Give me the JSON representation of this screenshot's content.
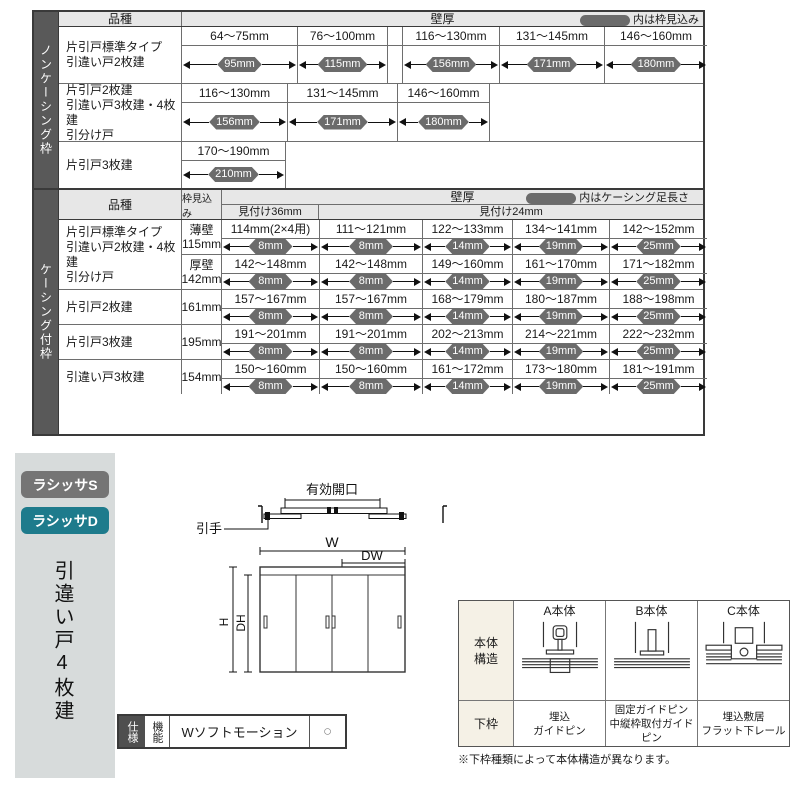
{
  "colors": {
    "accent_teal": "#1e7b8c",
    "badge_gray": "#757575",
    "capsule_gray": "#6b6b6b",
    "side_band_gray": "#595959",
    "header_bg": "#e7e7e7",
    "label_cream": "#f5f1e6",
    "sidebar_bg": "#d7dbdb"
  },
  "table1": {
    "side_label": "ノンケーシング枠",
    "header": {
      "kind": "品種",
      "wall": "壁厚",
      "legend": "内は枠見込み"
    },
    "rows": [
      {
        "label": "片引戸標準タイプ\n引違い戸2枚建",
        "h": 56,
        "subs": [
          {
            "fill": false,
            "cells": [
              {
                "range": "64〜75mm",
                "val": "95mm",
                "w": 115
              },
              {
                "range": "76〜100mm",
                "val": "115mm",
                "w": 90
              },
              {
                "spacer": true,
                "w": 15
              },
              {
                "range": "116〜130mm",
                "val": "156mm",
                "w": 97
              },
              {
                "range": "131〜145mm",
                "val": "171mm",
                "w": 105
              },
              {
                "range": "146〜160mm",
                "val": "180mm",
                "w": 103
              }
            ]
          }
        ]
      },
      {
        "label": "片引戸2枚建\n引違い戸3枚建・4枚建\n引分け戸",
        "h": 58,
        "subs": [
          {
            "fill": true,
            "cells": [
              {
                "range": "116〜130mm",
                "val": "156mm",
                "w": 105
              },
              {
                "range": "131〜145mm",
                "val": "171mm",
                "w": 110
              },
              {
                "range": "146〜160mm",
                "val": "180mm",
                "w": 92
              }
            ]
          }
        ]
      },
      {
        "label": "片引戸3枚建",
        "h": 47,
        "subs": [
          {
            "fill": true,
            "cells": [
              {
                "range": "170〜190mm",
                "val": "210mm",
                "w": 103
              }
            ]
          }
        ]
      }
    ]
  },
  "table2": {
    "side_label": "ケーシング付枠",
    "header": {
      "kind": "品種",
      "depth": "枠見込み",
      "wall": "壁厚",
      "legend": "内はケーシング足長さ",
      "sub36": "見付け36mm",
      "sub24": "見付け24mm"
    },
    "rows": [
      {
        "label": "片引戸標準タイプ\n引違い戸2枚建・4枚建\n引分け戸",
        "subs": [
          {
            "depth": "薄壁\n115mm",
            "h": 42,
            "cells": [
              {
                "range": "114mm(2×4用)",
                "val": "8mm",
                "w": 97
              },
              {
                "range": "111〜121mm",
                "val": "8mm",
                "w": 103
              },
              {
                "range": "122〜133mm",
                "val": "14mm",
                "w": 90
              },
              {
                "range": "134〜141mm",
                "val": "19mm",
                "w": 97
              },
              {
                "range": "142〜152mm",
                "val": "25mm",
                "w": 98
              }
            ]
          },
          {
            "depth": "厚壁\n142mm",
            "h": 42,
            "cells": [
              {
                "range": "142〜148mm",
                "val": "8mm",
                "w": 97
              },
              {
                "range": "142〜148mm",
                "val": "8mm",
                "w": 103
              },
              {
                "range": "149〜160mm",
                "val": "14mm",
                "w": 90
              },
              {
                "range": "161〜170mm",
                "val": "19mm",
                "w": 97
              },
              {
                "range": "171〜182mm",
                "val": "25mm",
                "w": 98
              }
            ]
          }
        ]
      },
      {
        "label": "片引戸2枚建",
        "subs": [
          {
            "depth": "161mm",
            "h": 44,
            "cells": [
              {
                "range": "157〜167mm",
                "val": "8mm",
                "w": 97
              },
              {
                "range": "157〜167mm",
                "val": "8mm",
                "w": 103
              },
              {
                "range": "168〜179mm",
                "val": "14mm",
                "w": 90
              },
              {
                "range": "180〜187mm",
                "val": "19mm",
                "w": 97
              },
              {
                "range": "188〜198mm",
                "val": "25mm",
                "w": 98
              }
            ]
          }
        ]
      },
      {
        "label": "片引戸3枚建",
        "subs": [
          {
            "depth": "195mm",
            "h": 44,
            "cells": [
              {
                "range": "191〜201mm",
                "val": "8mm",
                "w": 97
              },
              {
                "range": "191〜201mm",
                "val": "8mm",
                "w": 103
              },
              {
                "range": "202〜213mm",
                "val": "14mm",
                "w": 90
              },
              {
                "range": "214〜221mm",
                "val": "19mm",
                "w": 97
              },
              {
                "range": "222〜232mm",
                "val": "25mm",
                "w": 98
              }
            ]
          }
        ]
      },
      {
        "label": "引違い戸3枚建",
        "subs": [
          {
            "depth": "154mm",
            "h": 42,
            "cells": [
              {
                "range": "150〜160mm",
                "val": "8mm",
                "w": 97
              },
              {
                "range": "150〜160mm",
                "val": "8mm",
                "w": 103
              },
              {
                "range": "161〜172mm",
                "val": "14mm",
                "w": 90
              },
              {
                "range": "173〜180mm",
                "val": "19mm",
                "w": 97
              },
              {
                "range": "181〜191mm",
                "val": "25mm",
                "w": 98
              }
            ]
          }
        ]
      }
    ]
  },
  "sidebar": {
    "badges": [
      {
        "label": "ラシッサS"
      },
      {
        "label": "ラシッサD"
      }
    ],
    "title": "引違い戸4枚建"
  },
  "diagram": {
    "opening": "有効開口",
    "handle": "引手",
    "w": "W",
    "dw": "DW",
    "h": "H",
    "dh": "DH"
  },
  "spec": {
    "label1": "仕様",
    "label2": "機能",
    "feature": "Wソフトモーション",
    "mark": "○"
  },
  "structure": {
    "row1_label": "本体\n構造",
    "row2_label": "下枠",
    "cols": [
      {
        "title": "A本体",
        "lower": "埋込\nガイドピン"
      },
      {
        "title": "B本体",
        "lower": "固定ガイドピン\n中縦枠取付ガイドピン"
      },
      {
        "title": "C本体",
        "lower": "埋込敷居\nフラット下レール"
      }
    ],
    "note": "※下枠種類によって本体構造が異なります。"
  }
}
